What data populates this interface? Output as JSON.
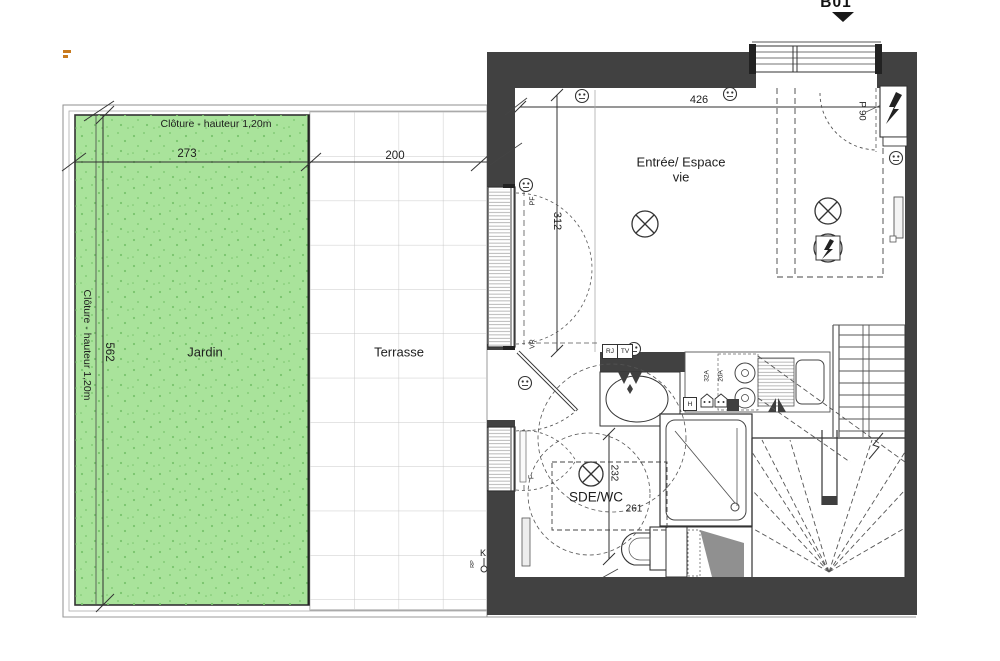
{
  "marker": {
    "label": "B01"
  },
  "colors": {
    "garden": "#a9e39b",
    "speckle": "#79c46c",
    "wall": "#414141",
    "gray": "#909090",
    "accent": "#c87a1e"
  },
  "site": {
    "fence_label_top": "Clôture - hauteur 1,20m",
    "fence_label_left": "Clôture - hauteur 1,20m",
    "garden_label": "Jardin",
    "terrace_label": "Terrasse",
    "dim_garden_width": "273",
    "dim_terrace_width": "200",
    "dim_garden_height": "562"
  },
  "interior": {
    "room_main_label": "Entrée/ Espace vie",
    "dim_width": "426",
    "dim_depth": "312",
    "door_label": "P 90",
    "bath": {
      "label": "SDE/WC",
      "dim_depth": "232",
      "dim_width": "261"
    },
    "tags": {
      "rj": "RJ",
      "tv": "TV",
      "h": "H",
      "amp32": "32A",
      "amp20": "20A",
      "pf": "PF",
      "vr": "VR",
      "f": "F",
      "k": "K",
      "rp": "RP"
    }
  }
}
